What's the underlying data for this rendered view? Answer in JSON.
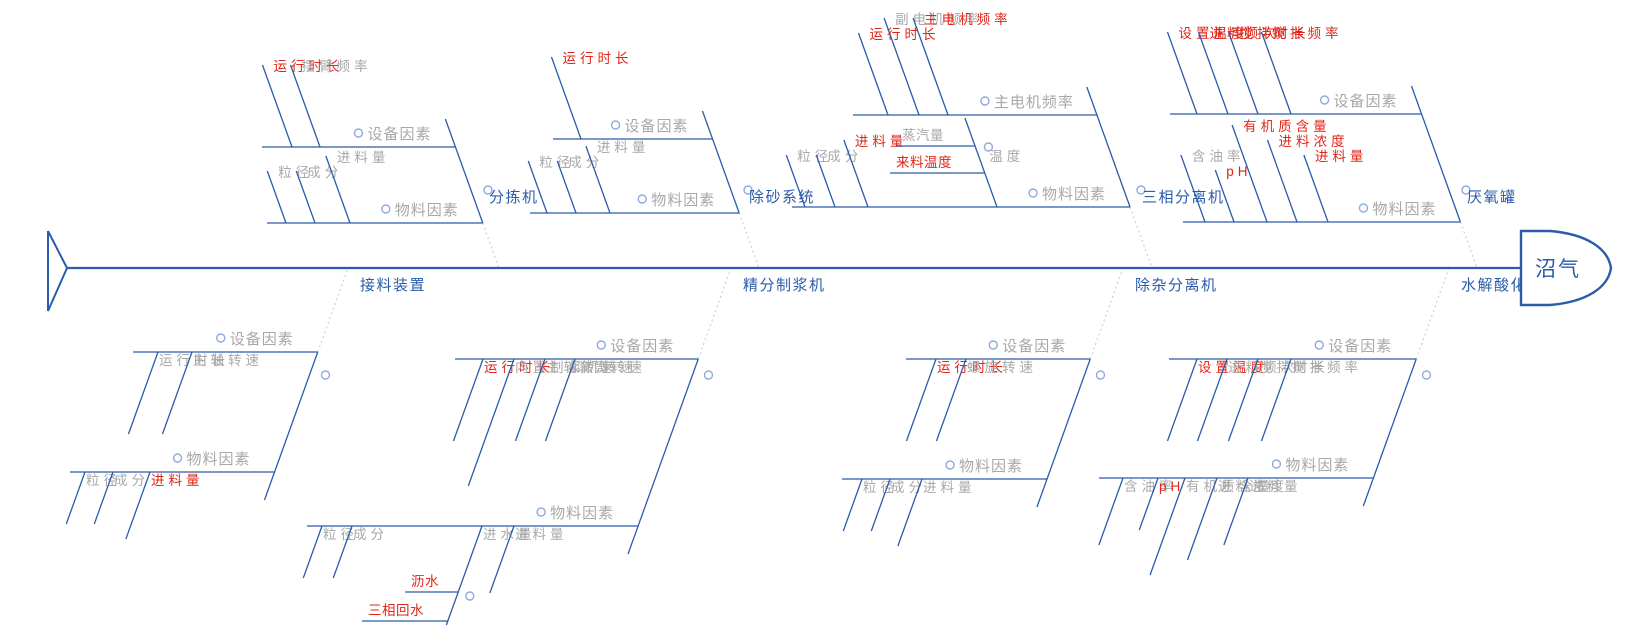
{
  "head": {
    "label": "沼气"
  },
  "colors": {
    "line_blue": "#2A5CAA",
    "text_gray": "#A8A8A8",
    "text_red": "#E0261A",
    "text_blue": "#2A5CAA",
    "dotted_gray": "#C9CFDC",
    "circle_stroke": "#8FAADC"
  },
  "diagram": {
    "spine_y": 268,
    "slope": 0.36,
    "branches": [
      {
        "name": "分拣机",
        "side": "top",
        "anchor_x": 499,
        "bones": [
          {
            "label": "设备因素",
            "y": 147,
            "x_left": 262,
            "leaves": [
              {
                "label": "运行时长",
                "color": "red",
                "x": 292
              },
              {
                "label": "摆臂频率",
                "color": "gray",
                "x": 320
              }
            ]
          },
          {
            "label": "物料因素",
            "y": 223,
            "x_left": 267,
            "leaves": [
              {
                "label": "粒径",
                "color": "gray",
                "x": 286
              },
              {
                "label": "成分",
                "color": "gray",
                "x": 315
              },
              {
                "label": "进料量",
                "color": "gray",
                "x": 350
              }
            ]
          }
        ]
      },
      {
        "name": "除砂系统",
        "side": "top",
        "anchor_x": 759,
        "bones": [
          {
            "label": "设备因素",
            "y": 139,
            "x_left": 553,
            "leaves": [
              {
                "label": "运行时长",
                "color": "red",
                "x": 581
              }
            ]
          },
          {
            "label": "物料因素",
            "y": 213,
            "x_left": 530,
            "leaves": [
              {
                "label": "粒径",
                "color": "gray",
                "x": 547
              },
              {
                "label": "成分",
                "color": "gray",
                "x": 576
              },
              {
                "label": "进料量",
                "color": "gray",
                "x": 610
              }
            ]
          }
        ]
      },
      {
        "name": "三相分离机",
        "side": "top",
        "anchor_x": 1152,
        "bones": [
          {
            "label": "主电机频率",
            "y": 115,
            "x_left": 853,
            "leaves": [
              {
                "label": "运行时长",
                "color": "red",
                "x": 888
              },
              {
                "label": "副电机频率",
                "color": "gray",
                "x": 919
              },
              {
                "label": "主电机频率",
                "color": "red",
                "x": 948
              }
            ]
          },
          {
            "label": "物料因素",
            "y": 207,
            "x_left": 792,
            "leaves": [
              {
                "label": "粒径",
                "color": "gray",
                "x": 805
              },
              {
                "label": "成分",
                "color": "gray",
                "x": 835
              },
              {
                "label": "进料量",
                "color": "red",
                "x": 868
              },
              {
                "label": "温度",
                "color": "gray",
                "x": 997,
                "sub": {
                  "tip_y": 118,
                  "subleaves": [
                    {
                      "label": "蒸汽量",
                      "color": "gray",
                      "y": 146,
                      "x_left": 896
                    },
                    {
                      "label": "来料温度",
                      "color": "red",
                      "y": 173,
                      "x_left": 890
                    }
                  ]
                }
              }
            ]
          }
        ]
      },
      {
        "name": "厌氧罐",
        "side": "top",
        "anchor_x": 1477,
        "bones": [
          {
            "label": "设备因素",
            "y": 114,
            "x_left": 1170,
            "leaves": [
              {
                "label": "设置温度",
                "color": "red",
                "x": 1197
              },
              {
                "label": "进料频次",
                "color": "red",
                "x": 1228
              },
              {
                "label": "搅拌时长",
                "color": "red",
                "x": 1258
              },
              {
                "label": "搅拌频率",
                "color": "red",
                "x": 1291
              }
            ]
          },
          {
            "label": "物料因素",
            "y": 222,
            "x_left": 1183,
            "leaves": [
              {
                "label": "含油率",
                "color": "gray",
                "x": 1205
              },
              {
                "label": "pH",
                "color": "red",
                "x": 1234
              },
              {
                "label": "有机质含量",
                "color": "red",
                "x": 1267
              },
              {
                "label": "进料浓度",
                "color": "red",
                "x": 1297
              },
              {
                "label": "进料量",
                "color": "red",
                "x": 1328
              }
            ]
          }
        ]
      },
      {
        "name": "接料装置",
        "side": "bottom",
        "anchor_x": 348,
        "bones": [
          {
            "label": "设备因素",
            "y": 352,
            "x_left": 133,
            "leaves": [
              {
                "label": "运行时长",
                "color": "gray",
                "x": 158
              },
              {
                "label": "主轴转速",
                "color": "gray",
                "x": 192
              }
            ]
          },
          {
            "label": "物料因素",
            "y": 472,
            "x_left": 70,
            "leaves": [
              {
                "label": "粒径",
                "color": "gray",
                "x": 85
              },
              {
                "label": "成分",
                "color": "gray",
                "x": 113
              },
              {
                "label": "进料量",
                "color": "red",
                "x": 150
              }
            ]
          }
        ]
      },
      {
        "name": "精分制浆机",
        "side": "bottom",
        "anchor_x": 731,
        "bones": [
          {
            "label": "设备因素",
            "y": 359,
            "x_left": 455,
            "leaves": [
              {
                "label": "运行时长",
                "color": "red",
                "x": 483
              },
              {
                "label": "内置制浆机转速",
                "color": "gray",
                "x": 514
              },
              {
                "label": "主轴转速",
                "color": "gray",
                "x": 545
              },
              {
                "label": "滚筒转速",
                "color": "gray",
                "x": 575
              }
            ]
          },
          {
            "label": "物料因素",
            "y": 526,
            "x_left": 307,
            "leaves": [
              {
                "label": "粒径",
                "color": "gray",
                "x": 322
              },
              {
                "label": "成分",
                "color": "gray",
                "x": 352
              },
              {
                "label": "进水量",
                "color": "gray",
                "x": 482,
                "sub": {
                  "tip_y": 625,
                  "subleaves": [
                    {
                      "label": "沥水",
                      "color": "red",
                      "y": 592,
                      "x_left": 405
                    },
                    {
                      "label": "三相回水",
                      "color": "red",
                      "y": 621,
                      "x_left": 362
                    }
                  ]
                }
              },
              {
                "label": "进料量",
                "color": "gray",
                "x": 514
              }
            ]
          }
        ]
      },
      {
        "name": "除杂分离机",
        "side": "bottom",
        "anchor_x": 1123,
        "bones": [
          {
            "label": "设备因素",
            "y": 359,
            "x_left": 906,
            "leaves": [
              {
                "label": "运行时长",
                "color": "red",
                "x": 936
              },
              {
                "label": "螺旋转速",
                "color": "gray",
                "x": 966
              }
            ]
          },
          {
            "label": "物料因素",
            "y": 479,
            "x_left": 842,
            "leaves": [
              {
                "label": "粒径",
                "color": "gray",
                "x": 862
              },
              {
                "label": "成分",
                "color": "gray",
                "x": 890
              },
              {
                "label": "进料量",
                "color": "gray",
                "x": 922
              }
            ]
          }
        ]
      },
      {
        "name": "水解酸化罐",
        "side": "bottom",
        "anchor_x": 1449,
        "bones": [
          {
            "label": "设备因素",
            "y": 359,
            "x_left": 1169,
            "leaves": [
              {
                "label": "设置温度",
                "color": "red",
                "x": 1197
              },
              {
                "label": "进料频次",
                "color": "gray",
                "x": 1227
              },
              {
                "label": "搅拌时长",
                "color": "gray",
                "x": 1258
              },
              {
                "label": "搅拌频率",
                "color": "gray",
                "x": 1291
              }
            ]
          },
          {
            "label": "物料因素",
            "y": 478,
            "x_left": 1099,
            "leaves": [
              {
                "label": "含油率",
                "color": "gray",
                "x": 1123
              },
              {
                "label": "pH",
                "color": "red",
                "x": 1158
              },
              {
                "label": "有机质含量",
                "color": "gray",
                "x": 1185
              },
              {
                "label": "进料浓度",
                "color": "gray",
                "x": 1217
              },
              {
                "label": "进料量",
                "color": "gray",
                "x": 1248
              }
            ]
          }
        ]
      }
    ]
  }
}
